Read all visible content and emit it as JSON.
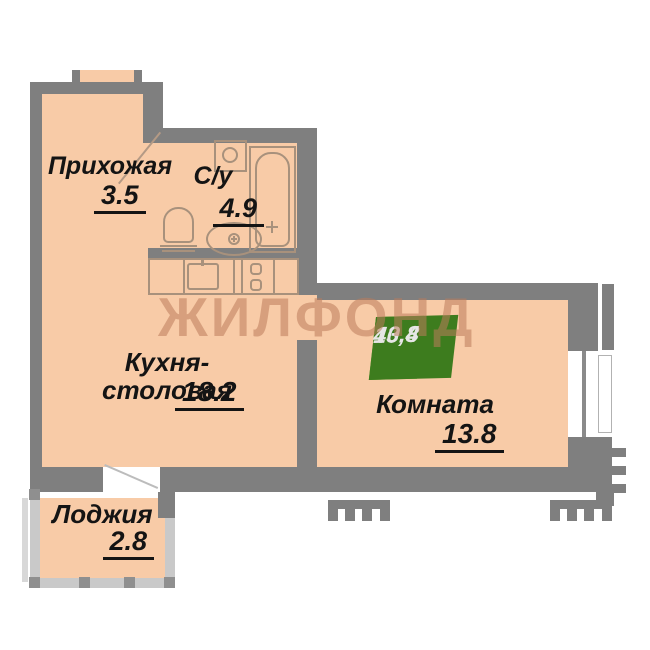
{
  "plan": {
    "watermark": "ЖИЛФОНД",
    "rooms": [
      {
        "id": "hallway",
        "label": "Прихожая",
        "area": "3.5"
      },
      {
        "id": "bathroom",
        "label": "С/у",
        "area": "4.9"
      },
      {
        "id": "kitchen",
        "label": "Кухня-столовая",
        "area": "18.2"
      },
      {
        "id": "room",
        "label": "Комната",
        "area": "13.8"
      },
      {
        "id": "loggia",
        "label": "Лоджия",
        "area": "2.8"
      }
    ],
    "badge": {
      "rooms_label": "1К",
      "room_area": "13,8",
      "total_area": "40,4",
      "light_green": "#5ca32c",
      "dark_green": "#3d7c1e"
    },
    "colors": {
      "floor": "#f8cba7",
      "wall": "#7f7f7f",
      "loggia_wall": "#c9c9c9",
      "fixture_outline": "#a8917c",
      "watermark": "rgba(187,124,91,0.55)"
    }
  }
}
